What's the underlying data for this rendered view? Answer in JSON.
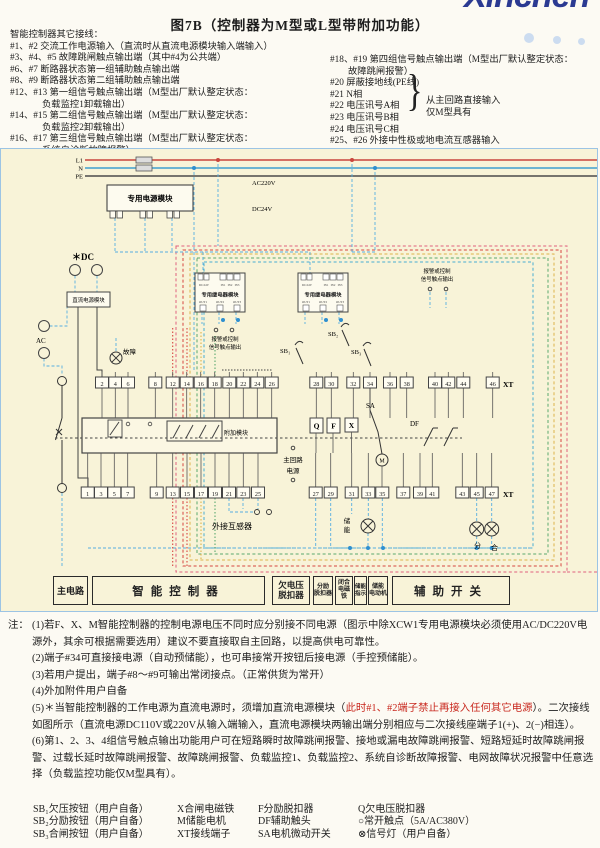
{
  "page": {
    "title": "图7B（控制器为M型或L型带附加功能）",
    "logo": "Xinchen"
  },
  "top_notes": {
    "heading": "智能控制器其它接线：",
    "left": [
      "#1、#2 交流工作电源输入（直流时从直流电源模块输入端输入）",
      "#3、#4、#5 故障跳闸触点输出端（其中#4为公共端）",
      "#6、#7 断路器状态第一组辅助触点输出端",
      "#8、#9 断路器状态第二组辅助触点输出端",
      "#12、#13 第一组信号触点输出端（M型出厂默认整定状态：",
      "负载监控1卸载输出）",
      "#14、#15 第二组信号触点输出端（M型出厂默认整定状态：",
      "负载监控2卸载输出）",
      "#16、#17 第三组信号触点输出端（M型出厂默认整定状态：",
      "系统自诊断故障报警）"
    ],
    "right": [
      "#18、#19 第四组信号触点输出端（M型出厂默认整定状态：",
      "故障跳闸报警）",
      "#20 屏蔽接地线(PE线)",
      "#21 N相",
      "#22 电压讯号A相",
      "#23 电压讯号B相",
      "#24 电压讯号C相",
      "#25、#26 外接中性极或地电流互感器输入"
    ],
    "brace": "}",
    "brace_note1": "从主回路直接输入",
    "brace_note2": "仅M型具有"
  },
  "diagram": {
    "labels": {
      "l1": "L1",
      "n": "N",
      "pe": "PE",
      "ac220v": "AC220V",
      "dc24v": "DC24V",
      "dc_star": "＊DC",
      "ac": "AC",
      "fault": "故障",
      "power_module": "专用电源模块",
      "dc_module": "直流电源模块",
      "relay_module": "专用继电器模块",
      "relay_dc": "DC24V",
      "relay_in1": "IN1",
      "relay_in2": "IN2",
      "relay_in3": "IN3",
      "relay_out1": "OUT1",
      "relay_out2": "OUT2",
      "relay_out3": "OUT3",
      "alarm1": "报警或控制",
      "alarm2": "信号触点输出",
      "add_module": "附加模块",
      "main1": "主回路",
      "main2": "电源",
      "ext_ct": "外接互感器",
      "store1": "储",
      "store2": "能",
      "open": "分",
      "close": "合",
      "xt": "XT",
      "sb1": "SB₁",
      "sb2": "SB₂",
      "sb3": "SB₃",
      "sa": "SA",
      "df": "DF",
      "q": "Q",
      "f": "F",
      "x": "X",
      "m": "M"
    },
    "xt_top": [
      "2",
      "4",
      "6",
      "8",
      "12",
      "14",
      "16",
      "18",
      "20",
      "22",
      "24",
      "26",
      "28",
      "30",
      "32",
      "34",
      "36",
      "38",
      "40",
      "42",
      "44",
      "46"
    ],
    "xt_bottom": [
      "1",
      "3",
      "5",
      "7",
      "9",
      "13",
      "15",
      "17",
      "19",
      "21",
      "23",
      "25",
      "27",
      "29",
      "31",
      "33",
      "35",
      "37",
      "39",
      "41",
      "43",
      "45",
      "47"
    ],
    "sections": [
      "主电路",
      "智能控制器",
      "欠电压\n脱扣器",
      "分励\n脱扣器",
      "闭合\n电磁铁",
      "储能\n指示",
      "储能\n电动机",
      "辅助开关"
    ]
  },
  "notes": {
    "marker": "注：",
    "n1": "(1)若F、X、M智能控制器的控制电源电压不同时应分别接不同电源（图示中除XCW1专用电源模块必须使用AC/DC220V电源外，其余可根据需要选用）建议不要直接取自主回路，以提高供电可靠性。",
    "n2": "(2)端子#34可直接接电源（自动预储能），也可串接常开按钮后接电源（手控预储能）。",
    "n3": "(3)若用户提出，端子#8～#9可输出常闭接点。（正常供货为常开）",
    "n4": "(4)外加附件用户自备",
    "n5a": "(5)＊当智能控制器的工作电源为直流电源时，须增加直流电源模块（",
    "n5red": "此时#1、#2端子禁止再接入任何其它电源",
    "n5b": "）。二次接线如图所示（直流电源DC110V或220V从输入端输入，直流电源模块两输出端分别相应与二次接线座端子1(+)、2(−)相连）。",
    "n6": "(6)第1、2、3、4组信号触点输出功能用户可在短路瞬时故障跳闸报警、接地或漏电故障跳闸报警、短路短延时故障跳闸报警、过载长延时故障跳闸报警、故障跳闸报警、负载监控1、负载监控2、系统自诊断故障报警、电网故障状况报警中任意选择（负载监控功能仅M型具有）。"
  },
  "legend": {
    "rows": [
      [
        "SB₁欠压按钮（用户自备）",
        "X合闸电磁铁",
        "F分励脱扣器",
        "Q欠电压脱扣器"
      ],
      [
        "SB₂分励按钮（用户自备）",
        "M储能电机",
        "DF辅助触头",
        "○常开触点（5A/AC380V）"
      ],
      [
        "SB₃合闸按钮（用户自备）",
        "XT接线端子",
        "SA电机微动开关",
        "⊗信号灯（用户自备）"
      ]
    ]
  },
  "colors": {
    "l1_red": "#c9453c",
    "n_blue": "#3f9fd0",
    "wire_blue": "#56aee0",
    "dash_red": "#d6453f",
    "dash_yellow": "#ddb34a",
    "dash_green": "#5aa86e",
    "dash_cyan": "#49add2",
    "dash_pink": "#e0607e",
    "logo_blue": "#2b3a92",
    "note_red": "#c8281e",
    "diagram_bg": "#f8f3d8"
  }
}
